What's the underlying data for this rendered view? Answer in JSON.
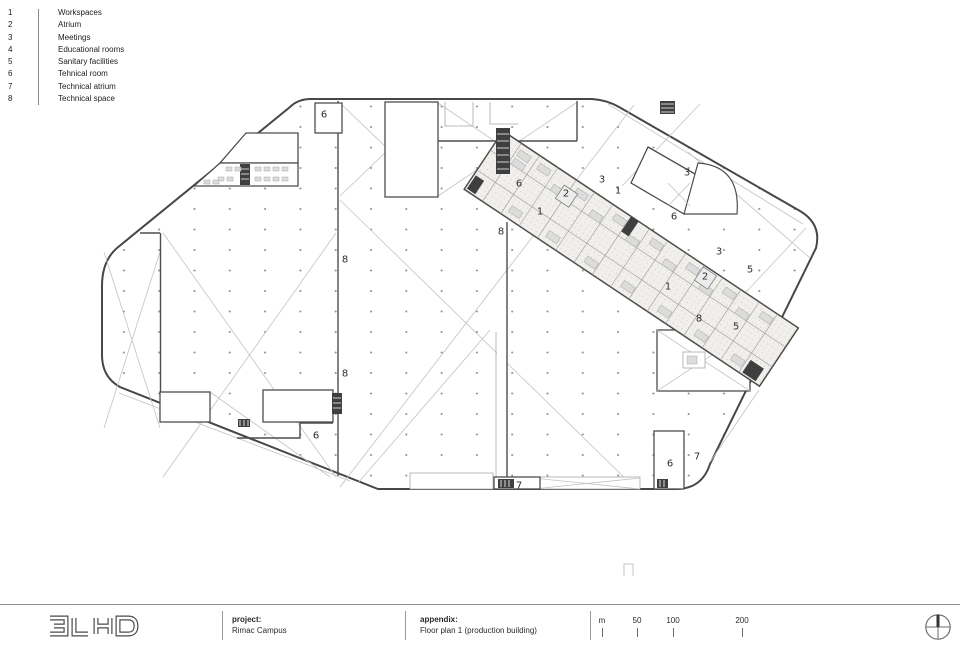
{
  "legend": {
    "items": [
      {
        "num": "1",
        "label": "Workspaces"
      },
      {
        "num": "2",
        "label": "Atrium"
      },
      {
        "num": "3",
        "label": "Meetings"
      },
      {
        "num": "4",
        "label": "Educational rooms"
      },
      {
        "num": "5",
        "label": "Sanitary facilities"
      },
      {
        "num": "6",
        "label": "Tehnical room"
      },
      {
        "num": "7",
        "label": "Technical atrium"
      },
      {
        "num": "8",
        "label": "Technical space"
      }
    ]
  },
  "plan": {
    "room_labels": [
      {
        "text": "6",
        "x": 324,
        "y": 114
      },
      {
        "text": "8",
        "x": 345,
        "y": 259
      },
      {
        "text": "8",
        "x": 345,
        "y": 373
      },
      {
        "text": "6",
        "x": 316,
        "y": 435
      },
      {
        "text": "7",
        "x": 519,
        "y": 485
      },
      {
        "text": "8",
        "x": 501,
        "y": 231
      },
      {
        "text": "6",
        "x": 519,
        "y": 183
      },
      {
        "text": "1",
        "x": 540,
        "y": 211
      },
      {
        "text": "2",
        "x": 566,
        "y": 193
      },
      {
        "text": "3",
        "x": 602,
        "y": 179
      },
      {
        "text": "1",
        "x": 618,
        "y": 190
      },
      {
        "text": "3",
        "x": 687,
        "y": 172
      },
      {
        "text": "6",
        "x": 674,
        "y": 216
      },
      {
        "text": "1",
        "x": 668,
        "y": 286
      },
      {
        "text": "2",
        "x": 705,
        "y": 276
      },
      {
        "text": "3",
        "x": 719,
        "y": 251
      },
      {
        "text": "5",
        "x": 750,
        "y": 269
      },
      {
        "text": "8",
        "x": 699,
        "y": 318
      },
      {
        "text": "5",
        "x": 736,
        "y": 326
      },
      {
        "text": "6",
        "x": 670,
        "y": 463
      },
      {
        "text": "7",
        "x": 697,
        "y": 456
      }
    ],
    "colors": {
      "wall": "#4d4d4d",
      "light_wall": "#a8a8a8",
      "brace": "#c3c3c3",
      "grid_dot": "#8f8f8f",
      "label_text": "#2f2f2f"
    }
  },
  "footer": {
    "logo": "3LHD",
    "project": {
      "label": "project:",
      "value": "Rimac Campus"
    },
    "appendix": {
      "label": "appendix:",
      "value": "Floor plan 1 (production building)"
    },
    "scale": {
      "unit": "m",
      "marks": [
        "50",
        "100",
        "200"
      ]
    }
  }
}
